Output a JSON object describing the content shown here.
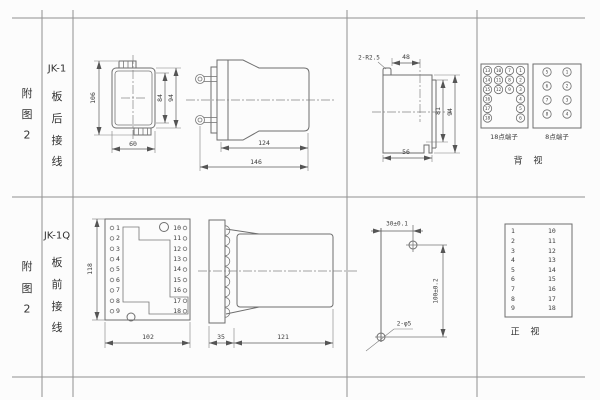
{
  "rows": [
    {
      "fig": [
        "附",
        "图",
        "2"
      ],
      "model": "JK-1",
      "wiring": [
        "板",
        "后",
        "接",
        "线"
      ]
    },
    {
      "fig": [
        "附",
        "图",
        "2"
      ],
      "model": "JK-1Q",
      "wiring": [
        "板",
        "前",
        "接",
        "线"
      ]
    }
  ],
  "jk1_front": {
    "dim_height": "106",
    "dim_inner": "84",
    "dim_outer": "94",
    "dim_width": "60"
  },
  "jk1_side": {
    "dim_body": "124",
    "dim_total": "146"
  },
  "jk1_cutout": {
    "corner": "2-R2.5",
    "dim_top": "48",
    "dim_inner": "81",
    "dim_outer": "94",
    "dim_width": "56"
  },
  "jk1_terminals": {
    "box18": {
      "label": "18点端子",
      "columns": [
        [
          "13",
          "14",
          "15",
          "16",
          "17",
          "18"
        ],
        [
          "10",
          "11",
          "12"
        ],
        [
          "7",
          "8",
          "9"
        ],
        [
          "1",
          "2",
          "3",
          "4",
          "5",
          "6"
        ]
      ]
    },
    "box8": {
      "label": "8点端子",
      "columns": [
        [
          "5",
          "6",
          "7",
          "8"
        ],
        [
          "1",
          "2",
          "3",
          "4"
        ]
      ]
    },
    "view": "背 视"
  },
  "jk1q_front": {
    "left": [
      "1",
      "2",
      "3",
      "4",
      "5",
      "6",
      "7",
      "8",
      "9"
    ],
    "right": [
      "10",
      "11",
      "12",
      "13",
      "14",
      "15",
      "16",
      "17",
      "18"
    ],
    "dim_height": "118",
    "dim_width": "102"
  },
  "jk1q_side": {
    "dim_plate": "35",
    "dim_body": "121"
  },
  "jk1q_drill": {
    "dim_h": "30±0.1",
    "dim_v": "100±0.2",
    "holes": "2-φ5"
  },
  "jk1q_table": {
    "left": [
      "1",
      "2",
      "3",
      "4",
      "5",
      "6",
      "7",
      "8",
      "9"
    ],
    "right": [
      "10",
      "11",
      "12",
      "13",
      "14",
      "15",
      "16",
      "17",
      "18"
    ],
    "view": "正 视"
  }
}
